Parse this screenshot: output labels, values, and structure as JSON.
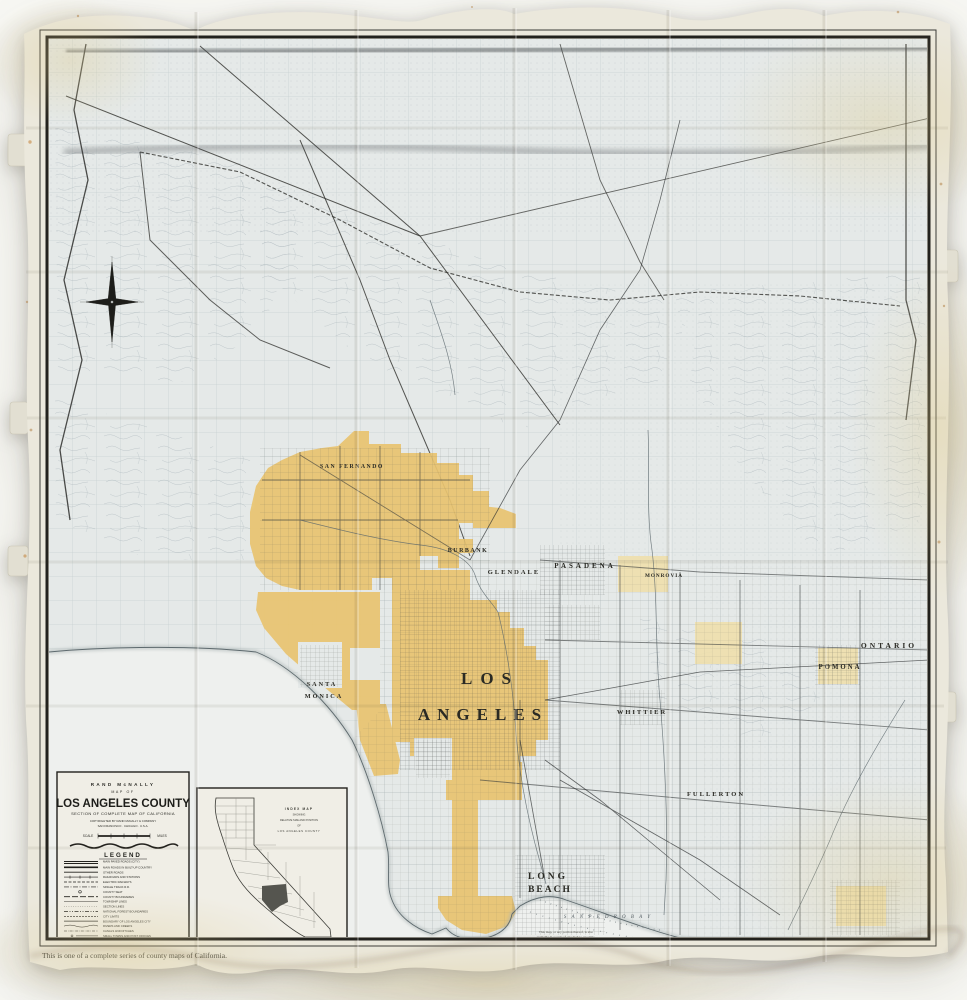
{
  "colors": {
    "city_fill": "#e9c470",
    "pale_city_fill": "#efe0ad",
    "paper": "#ebe8dc",
    "map_base": "#e5e9e8",
    "water": "#eef0ee",
    "frame_ink": "#22211d"
  },
  "title_block": {
    "publisher": "RAND McNALLY",
    "map_of": "MAP OF",
    "title": "LOS ANGELES COUNTY",
    "subtitle": "SECTION OF COMPLETE MAP OF CALIFORNIA",
    "copyright": "COPYRIGHTED BY RAND McNALLY & COMPANY",
    "imprint": "SAN FRANCISCO · CHICAGO · U.S.A.",
    "scale_label": "SCALE",
    "miles_label": "MILES",
    "legend_heading": "LEGEND"
  },
  "legend": {
    "items": [
      "MAIN PAVED ROADS (CITY)",
      "MAIN ROADS IN BUILT-UP COUNTRY",
      "OTHER ROADS",
      "RAILROADS AND STATIONS",
      "ELECTRIC RAILWAYS",
      "SINGLE TRACK R.R.",
      "COUNTY SEAT",
      "COUNTY BOUNDARIES",
      "TOWNSHIP LINES",
      "SECTION LINES",
      "NATIONAL FOREST BOUNDARIES",
      "CITY LIMITS",
      "BOUNDARY OF LOS ANGELES CITY",
      "RIVERS AND CREEKS",
      "CANALS AND DITCHES",
      "SMALL TOWNS AND POST OFFICES"
    ]
  },
  "inset": {
    "line1": "INDEX MAP",
    "line2": "SHOWING",
    "line3": "RELATIVE SIZE AND POSITION",
    "line4": "OF",
    "line5": "LOS ANGELES COUNTY"
  },
  "map": {
    "labels": {
      "los": "LOS",
      "angeles": "ANGELES",
      "long": "LONG",
      "beach": "BEACH",
      "pasadena": "PASADENA",
      "glendale": "GLENDALE",
      "burbank": "BURBANK",
      "san_fernando": "SAN FERNANDO",
      "santa": "SANTA",
      "monica": "MONICA",
      "whittier": "WHITTIER",
      "fullerton": "FULLERTON",
      "pomona": "POMONA",
      "ontario": "ONTARIO",
      "monrovia": "MONROVIA",
      "san_pedro_bay": "S A N   P E D R O   B A Y"
    }
  },
  "footnotes": {
    "caption_left": "This is one of a complete series of county maps of California.",
    "right_line1": "This map, or any portion thereof, is also",
    "right_line2": "available in a scale of one inch to one mile."
  }
}
